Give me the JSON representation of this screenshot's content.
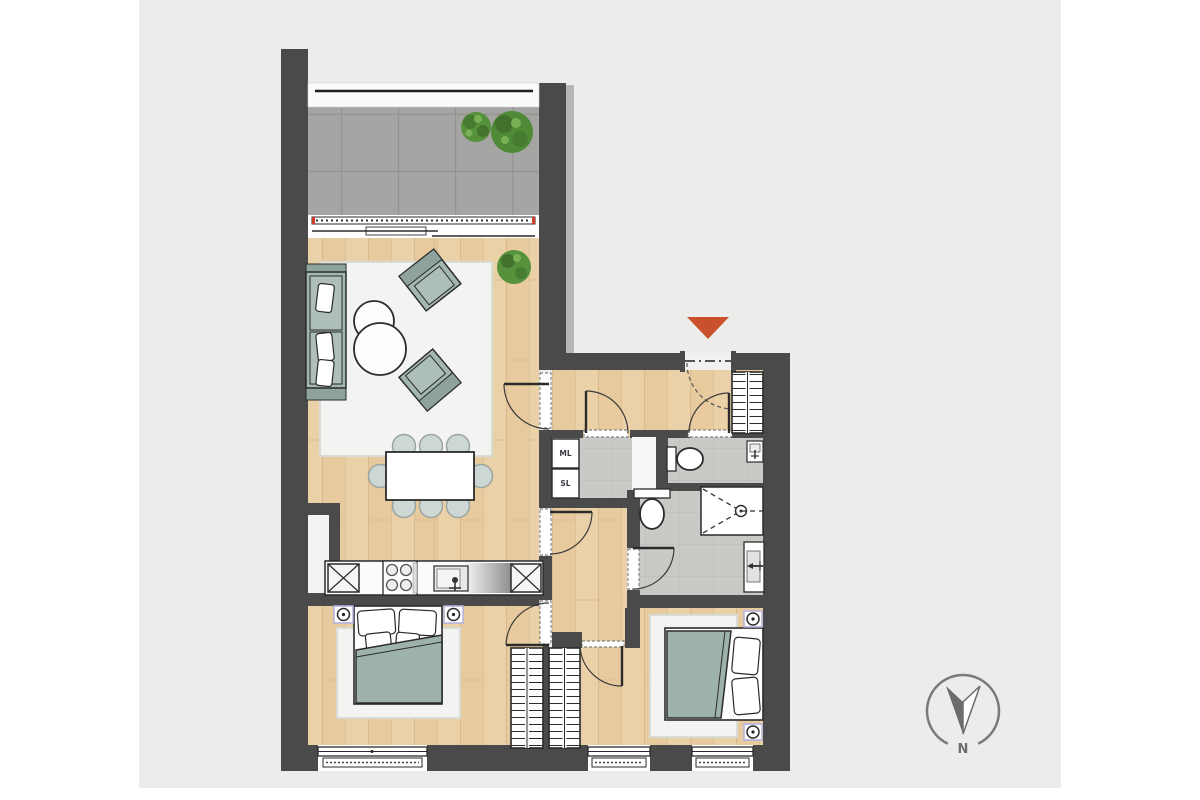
{
  "page": {
    "background_color": "#ffffff",
    "canvas_color": "#ececea"
  },
  "floor_plan": {
    "type": "apartment-floor-plan",
    "rooms": [
      "balcony",
      "living-dining-room",
      "entry-hall",
      "laundry-closet",
      "wc",
      "bathroom",
      "hallway",
      "master-bedroom",
      "bedroom-2"
    ],
    "appliance_labels": {
      "washer": "ML",
      "dryer": "SL"
    },
    "compass": {
      "label": "N",
      "direction": "down"
    },
    "entrance_marker_color": "#c8502d",
    "colors": {
      "walls": "#4a4a4a",
      "wood_floor": "#ebd1a8",
      "balcony_tiles": "#a2a2a0",
      "bath_tiles": "#c9c9c6",
      "furniture_upholstery": "#a3b6b1",
      "rug": "#f3f3f1",
      "plant": "#55923b",
      "sliding_door_accent": "#d13b2a"
    }
  }
}
